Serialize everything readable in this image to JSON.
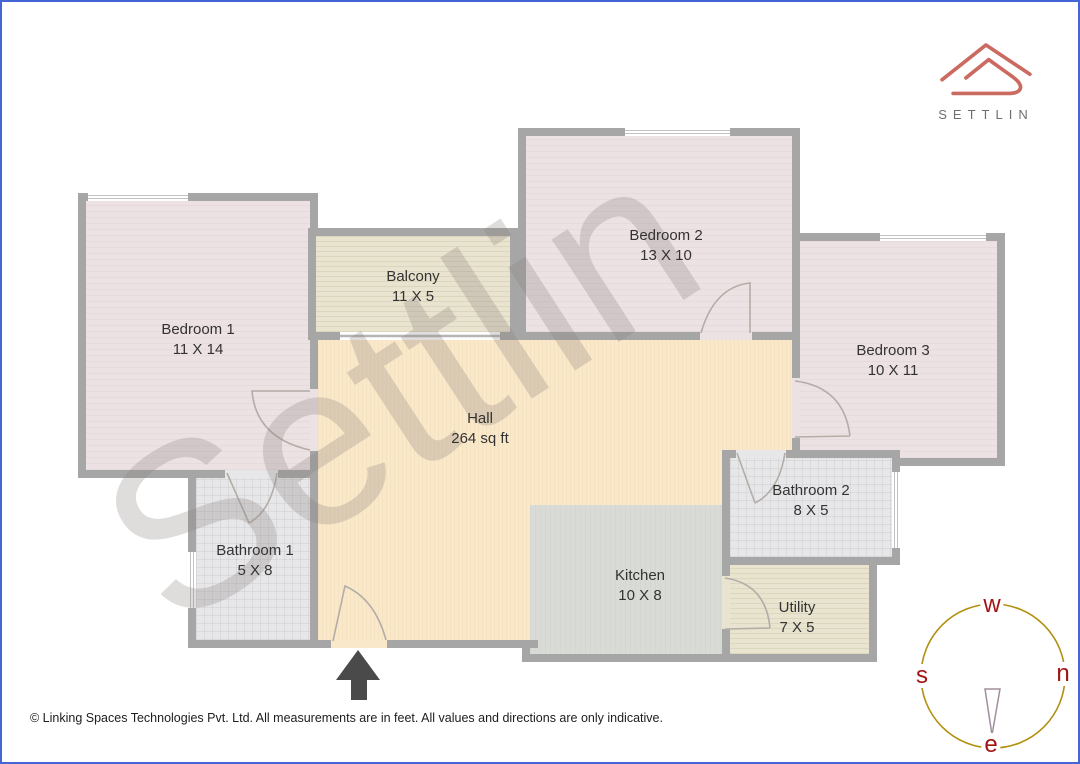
{
  "brand": {
    "name": "SETTLIN"
  },
  "watermark": {
    "text": "Settlin"
  },
  "rooms": [
    {
      "name": "Bedroom 1",
      "size": "11 X 14"
    },
    {
      "name": "Balcony",
      "size": "11 X 5"
    },
    {
      "name": "Bedroom 2",
      "size": "13 X 10"
    },
    {
      "name": "Bedroom 3",
      "size": "10 X 11"
    },
    {
      "name": "Hall",
      "size": "264 sq ft"
    },
    {
      "name": "Bathroom 1",
      "size": "5 X 8"
    },
    {
      "name": "Bathroom 2",
      "size": "8 X 5"
    },
    {
      "name": "Kitchen",
      "size": "10 X 8"
    },
    {
      "name": "Utility",
      "size": "7 X 5"
    }
  ],
  "compass": {
    "top": "w",
    "right": "n",
    "left": "s",
    "bottom": "e"
  },
  "footer": {
    "text": "© Linking Spaces Technologies Pvt. Ltd. All measurements are in feet. All values and directions are only indicative."
  },
  "colors": {
    "wall": "#a6a6a6",
    "bedroom_fill": "#ece1e3",
    "balcony_utility_fill": "#e9e4cf",
    "hall_fill": "#f9e8ca",
    "bathroom_fill": "#e7e7e9",
    "kitchen_fill": "#d9dbd6",
    "logo_red": "#cb6a60",
    "compass_ring": "#b2900e",
    "compass_letters": "#a01616",
    "frame_blue": "#4365d6",
    "entrance_arrow": "#4a4a4a"
  }
}
